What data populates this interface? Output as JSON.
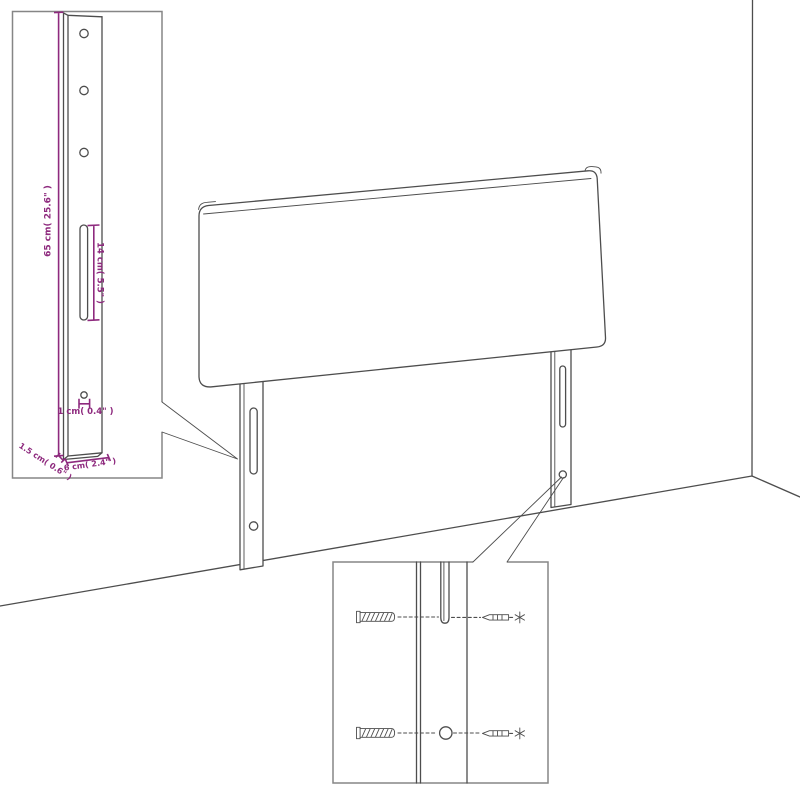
{
  "title": "Headboard wall-mounting assembly diagram",
  "colors": {
    "line": "#4d4d4d",
    "inset_border": "#868686",
    "dimension": "#8e2a7e",
    "background": "#ffffff"
  },
  "leg_detail_inset": {
    "description": "close-up of mounting leg with dimensions",
    "labels": {
      "leg_height": "65 cm( 25.6\" )",
      "slot_length": "14 cm( 5.5\" )",
      "hole_diameter": "1 cm( 0.4\" )",
      "leg_depth": "1.5 cm( 0.6\" )",
      "leg_width": "6 cm( 2.4\" )"
    }
  },
  "mount_detail_inset": {
    "description": "close-up of leg slot and hole with wall plugs and screws",
    "parts": [
      "wall-plug",
      "screw",
      "leg-slot",
      "leg-hole"
    ]
  }
}
